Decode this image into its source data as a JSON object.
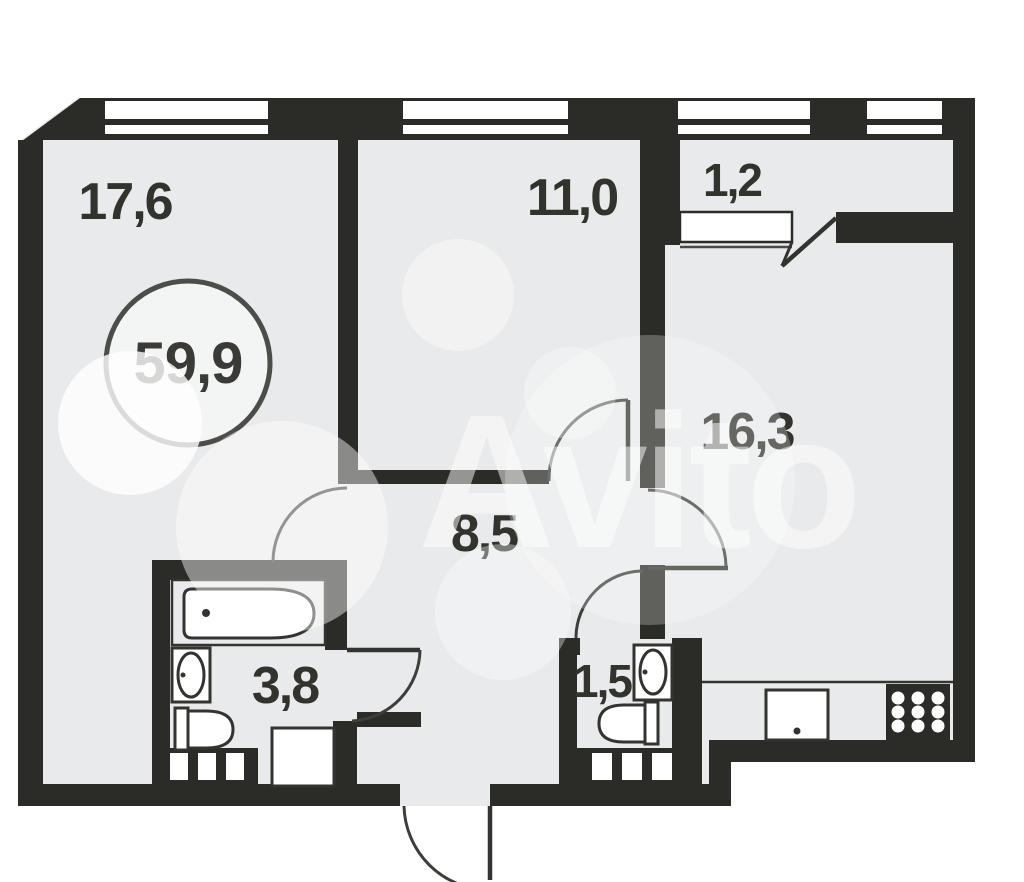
{
  "floorplan": {
    "watermark": "Avito",
    "total_area": {
      "value": "59,9"
    },
    "rooms": [
      {
        "name": "living-room",
        "area": "17,6"
      },
      {
        "name": "bedroom",
        "area": "11,0"
      },
      {
        "name": "balcony",
        "area": "1,2"
      },
      {
        "name": "kitchen-living",
        "area": "16,3"
      },
      {
        "name": "hallway",
        "area": "8,5"
      },
      {
        "name": "bathroom",
        "area": "3,8"
      },
      {
        "name": "toilet",
        "area": "1,5"
      }
    ],
    "colors": {
      "wall": "#2b2b27",
      "floor": "#e9eaeb",
      "line": "#3d3d39",
      "label": "#33332e",
      "watermark": "#ffffff",
      "background": "#ffffff"
    }
  }
}
